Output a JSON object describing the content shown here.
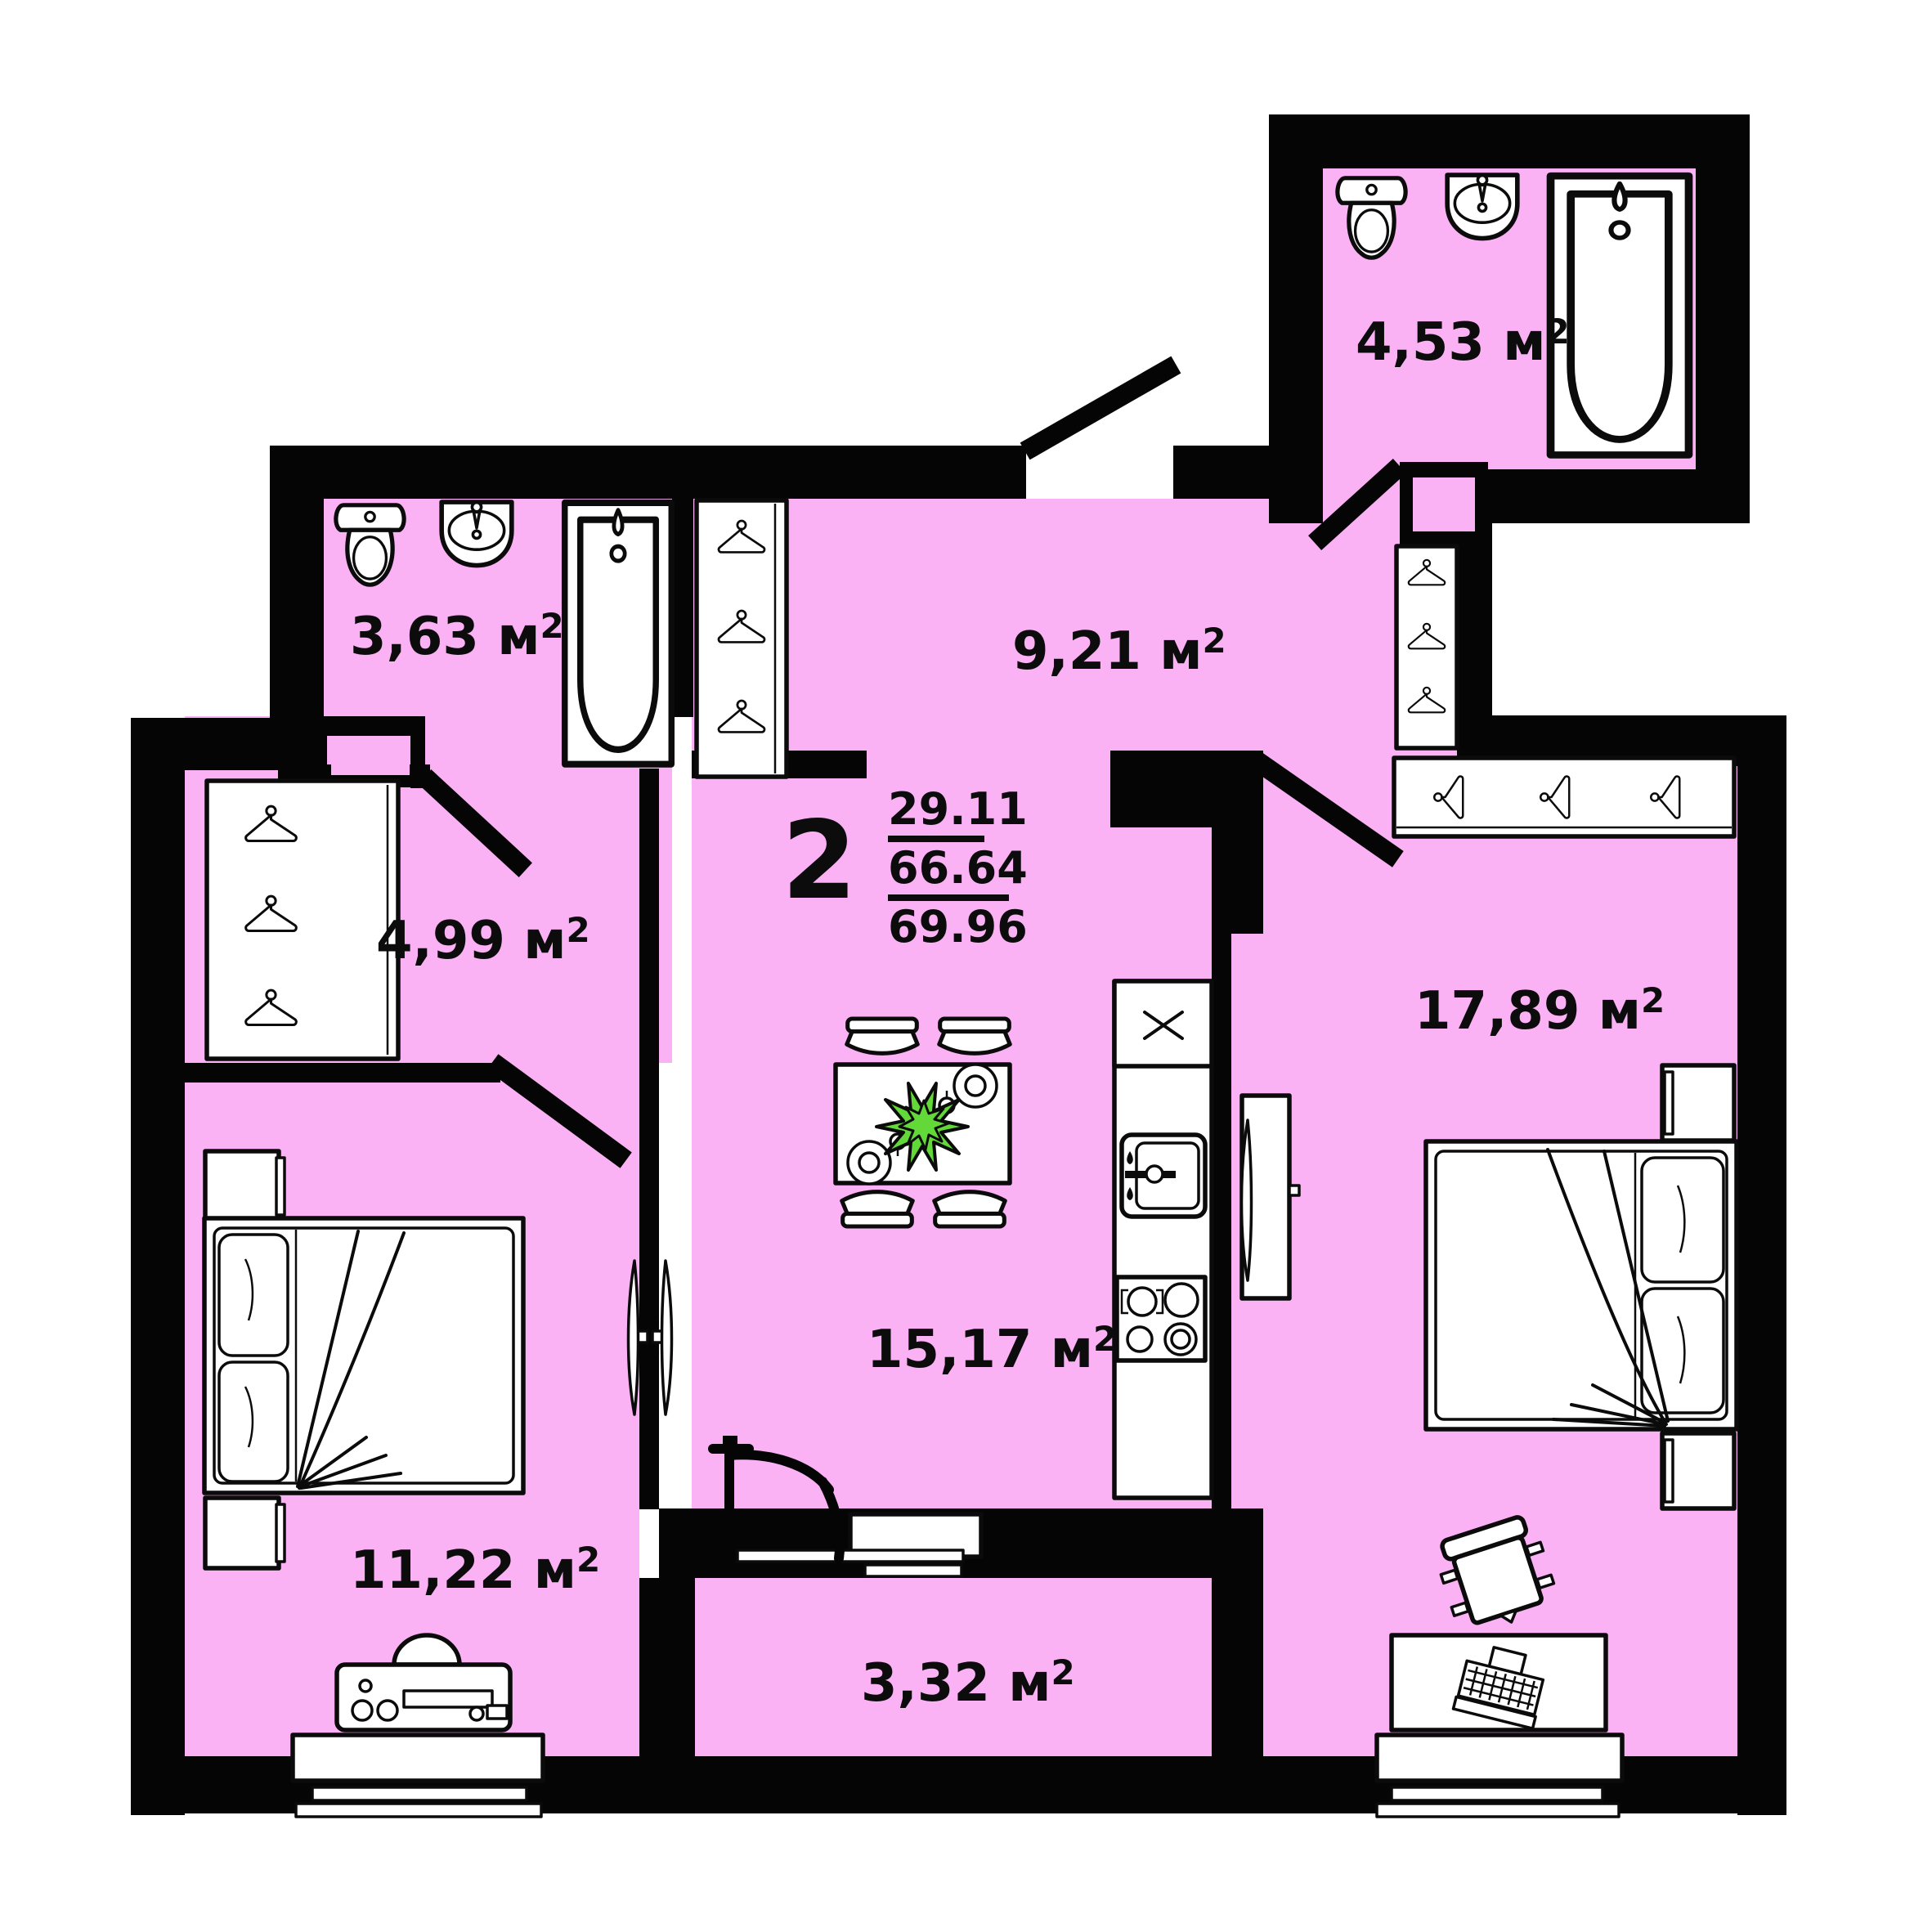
{
  "plan": {
    "type": "apartment-floor-plan",
    "unit": " м",
    "sup": "2",
    "summary": {
      "rooms": "2",
      "line1": "29.11",
      "line2": "66.64",
      "line3": "69.96"
    },
    "rooms": [
      {
        "key": "bathroom-top-right",
        "area": "4,53"
      },
      {
        "key": "bathroom-top-left",
        "area": "3,63"
      },
      {
        "key": "hallway",
        "area": "9,21"
      },
      {
        "key": "corridor",
        "area": "4,99"
      },
      {
        "key": "bedroom-right",
        "area": "17,89"
      },
      {
        "key": "kitchen-living",
        "area": "15,17"
      },
      {
        "key": "bedroom-left",
        "area": "11,22"
      },
      {
        "key": "balcony",
        "area": "3,32"
      }
    ],
    "furniture_icons": [
      "toilet-icon",
      "sink-icon",
      "bathtub-icon",
      "hanger-icon",
      "wardrobe",
      "bed",
      "pillow",
      "nightstand",
      "dining-table",
      "chair",
      "plate-icon",
      "plant-icon",
      "fridge-icon",
      "kitchen-sink-icon",
      "stove-icon",
      "tv-icon",
      "desk",
      "laptop-icon",
      "office-chair",
      "dresser-icon",
      "window",
      "door-leaf",
      "drying-rack-icon"
    ],
    "colors": {
      "floor": "#FAB2F5",
      "wall": "#050505",
      "plant": "#63D839",
      "furniture": "#FFFFFF",
      "text": "#0C0C0C"
    }
  }
}
